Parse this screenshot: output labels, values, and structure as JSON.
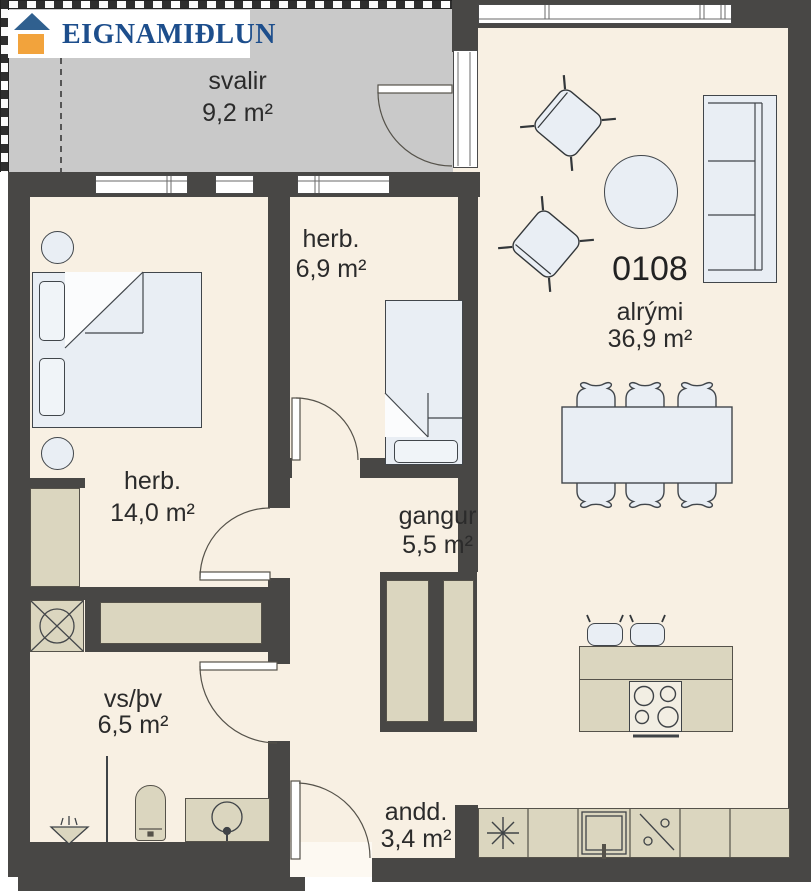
{
  "logo": {
    "text": "EIGNAMIÐLUN"
  },
  "unit_number": "0108",
  "rooms": {
    "svalir": {
      "label": "svalir",
      "area": "9,2 m²"
    },
    "herb_small": {
      "label": "herb.",
      "area": "6,9 m²"
    },
    "alrymi": {
      "label": "alrými",
      "area": "36,9 m²"
    },
    "herb_large": {
      "label": "herb.",
      "area": "14,0 m²"
    },
    "gangur": {
      "label": "gangur",
      "area": "5,5 m²"
    },
    "vspv": {
      "label": "vs/þv",
      "area": "6,5 m²"
    },
    "andd": {
      "label": "andd.",
      "area": "3,4 m²"
    }
  },
  "colors": {
    "wall": "#484745",
    "floor": "#f8f0e3",
    "balcony": "#c9c9c9",
    "furniture": "#e9eef4",
    "fixture": "#dbd6bf",
    "logo_blue": "#1d4e8c",
    "logo_orange": "#f2a33c"
  }
}
